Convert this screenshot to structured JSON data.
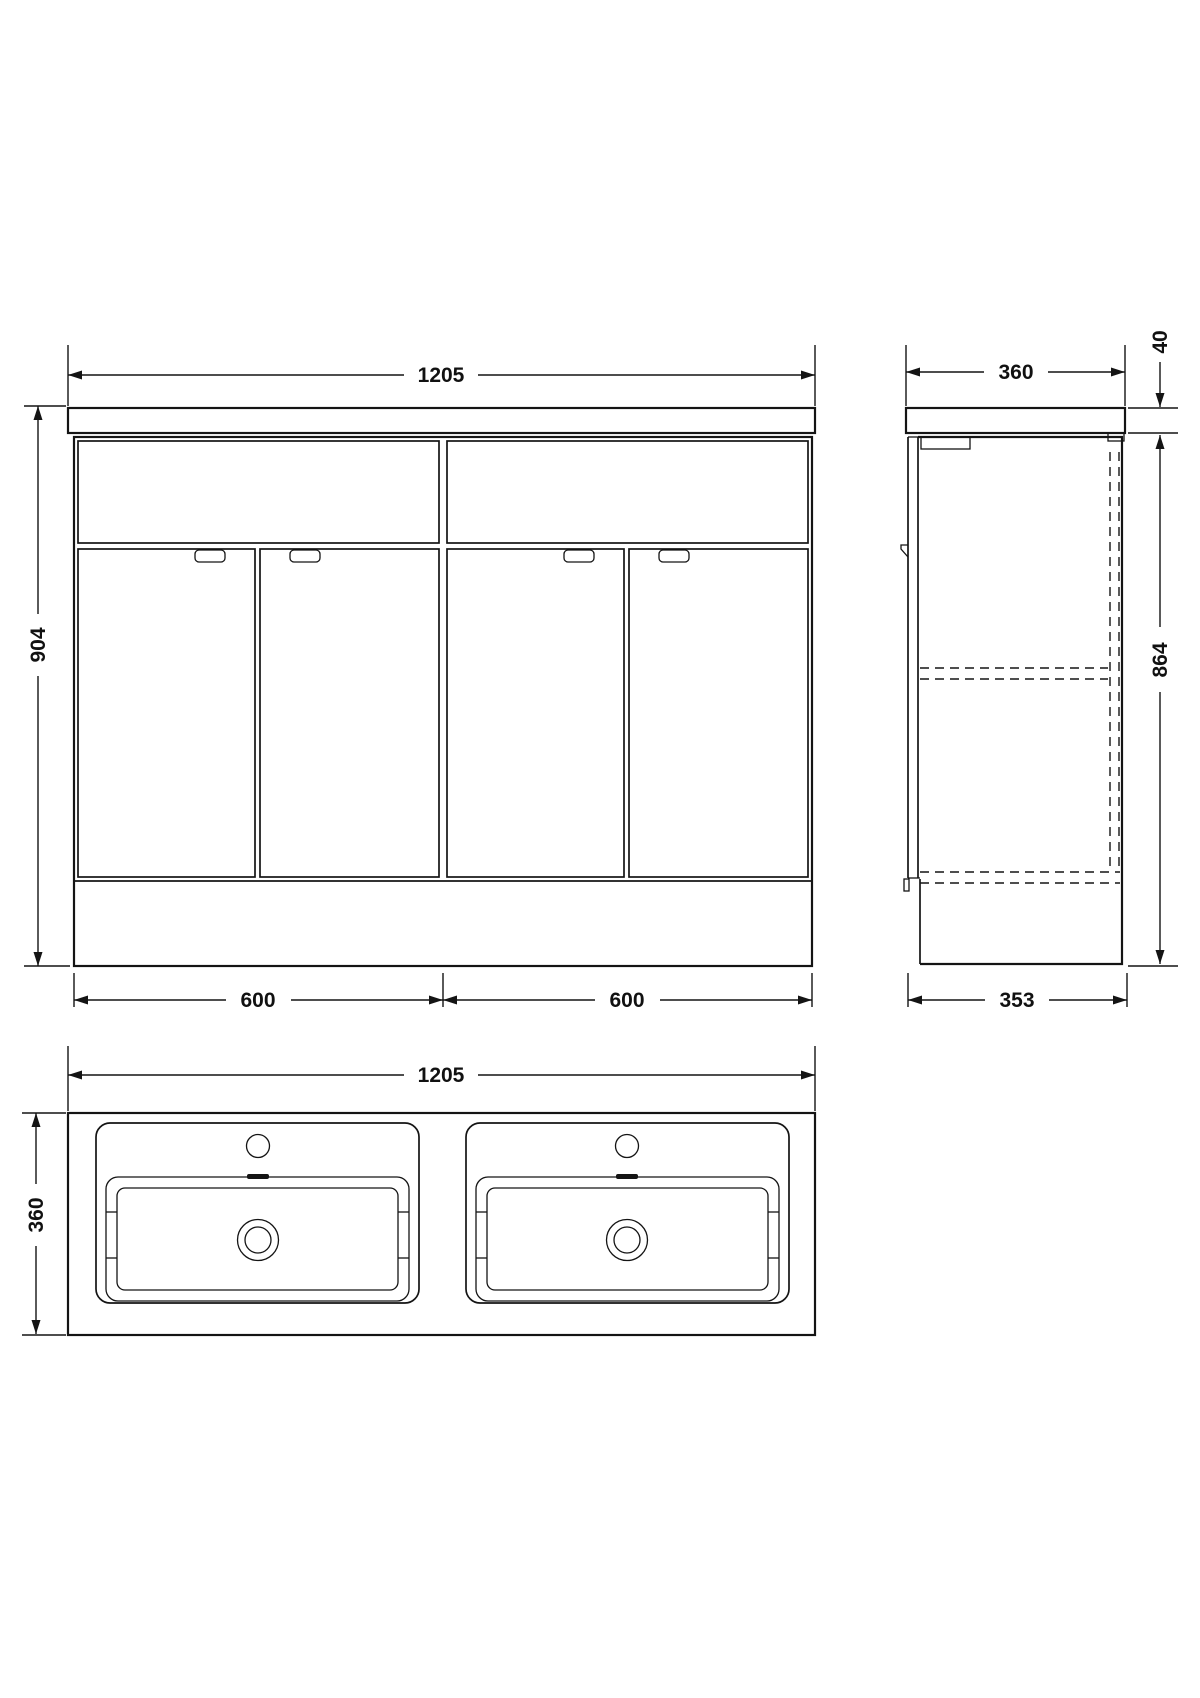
{
  "drawing": {
    "front_view": {
      "overall_width": "1205",
      "overall_height": "904",
      "left_unit_width": "600",
      "right_unit_width": "600"
    },
    "side_view": {
      "worktop_depth": "360",
      "worktop_thickness": "40",
      "cabinet_height": "864",
      "plinth_depth": "353"
    },
    "plan_view": {
      "overall_width": "1205",
      "overall_depth": "360"
    }
  }
}
